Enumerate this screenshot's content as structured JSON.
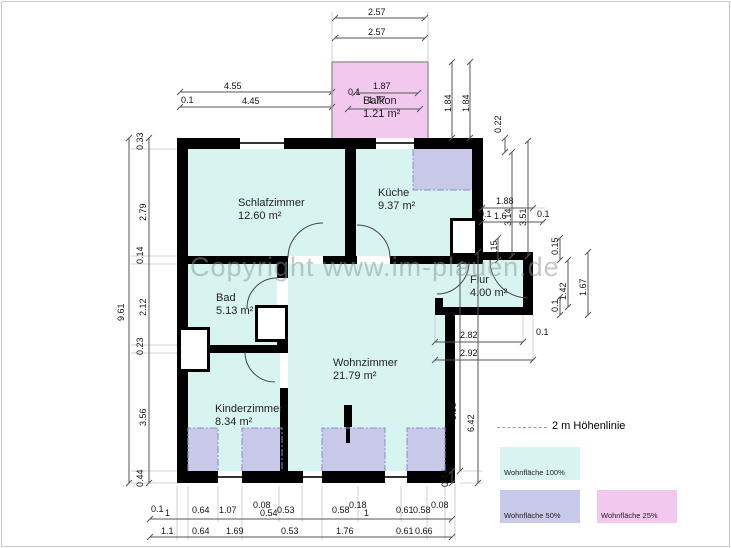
{
  "watermark": "Copyright www.im-plauen.de",
  "colors": {
    "room": "#d8f4f1",
    "area50": "#c8c8e9",
    "area25": "#f3c8ef",
    "wall": "#000000",
    "dim_line": "#555555",
    "ext_line": "#c4c4c4",
    "hoehenlinie": "#8c8cc8"
  },
  "rooms": [
    {
      "name": "Schlafzimmer",
      "area": "12.60 m²",
      "x": 238,
      "y": 197
    },
    {
      "name": "Küche",
      "area": "9.37 m²",
      "x": 378,
      "y": 187
    },
    {
      "name": "Bad",
      "area": "5.13 m²",
      "x": 216,
      "y": 292
    },
    {
      "name": "Flur",
      "area": "4.00 m²",
      "x": 470,
      "y": 274
    },
    {
      "name": "Wohnzimmer",
      "area": "21.79 m²",
      "x": 333,
      "y": 357
    },
    {
      "name": "Kinderzimmer",
      "area": "8.34 m²",
      "x": 215,
      "y": 403
    },
    {
      "name": "Balkon",
      "area": "1.21 m²",
      "x": 363,
      "y": 95
    }
  ],
  "legend": {
    "line_label": "2 m Höhenlinie",
    "items": [
      {
        "label": "Wohnfläche 100%",
        "color": "#d8f4f1",
        "x": 500,
        "y": 447
      },
      {
        "label": "Wohnfläche 50%",
        "color": "#c8c8e9",
        "x": 500,
        "y": 490
      },
      {
        "label": "Wohnfläche 25%",
        "color": "#f3c8ef",
        "x": 597,
        "y": 490
      }
    ]
  },
  "fills": [
    {
      "n": "room-fill-schlafzimmer",
      "x": 188,
      "y": 149,
      "w": 157,
      "h": 107,
      "c": "room"
    },
    {
      "n": "room-fill-kueche",
      "x": 356,
      "y": 149,
      "w": 116,
      "h": 107,
      "c": "room"
    },
    {
      "n": "area50-kueche",
      "x": 413,
      "y": 149,
      "w": 59,
      "h": 41,
      "c": "area50"
    },
    {
      "n": "room-fill-bad",
      "x": 188,
      "y": 264,
      "w": 89,
      "h": 81,
      "c": "room"
    },
    {
      "n": "room-fill-kinderzimmer",
      "x": 188,
      "y": 353,
      "w": 92,
      "h": 118,
      "c": "room"
    },
    {
      "n": "room-fill-wohnzimmer",
      "x": 288,
      "y": 264,
      "w": 157,
      "h": 207,
      "c": "room"
    },
    {
      "n": "room-fill-flur",
      "x": 443,
      "y": 260,
      "w": 80,
      "h": 47,
      "c": "room"
    },
    {
      "n": "room-fill-flur-passage",
      "x": 435,
      "y": 264,
      "w": 8,
      "h": 34,
      "c": "room"
    },
    {
      "n": "area50-strip-1",
      "x": 188,
      "y": 428,
      "w": 30,
      "h": 43,
      "c": "area50"
    },
    {
      "n": "area50-strip-2",
      "x": 242,
      "y": 428,
      "w": 40,
      "h": 43,
      "c": "area50"
    },
    {
      "n": "area50-strip-3",
      "x": 322,
      "y": 428,
      "w": 63,
      "h": 43,
      "c": "area50"
    },
    {
      "n": "area50-strip-4",
      "x": 407,
      "y": 428,
      "w": 38,
      "h": 43,
      "c": "area50"
    },
    {
      "n": "area25-balkon",
      "x": 332,
      "y": 62,
      "w": 96,
      "h": 76,
      "c": "area25"
    }
  ],
  "walls": [
    {
      "x": 177,
      "y": 138,
      "w": 11,
      "h": 345
    },
    {
      "x": 177,
      "y": 138,
      "w": 63,
      "h": 11
    },
    {
      "x": 284,
      "y": 138,
      "w": 92,
      "h": 11
    },
    {
      "x": 414,
      "y": 138,
      "w": 69,
      "h": 11
    },
    {
      "x": 345,
      "y": 149,
      "w": 11,
      "h": 107
    },
    {
      "x": 472,
      "y": 149,
      "w": 11,
      "h": 103
    },
    {
      "x": 472,
      "y": 252,
      "w": 61,
      "h": 8
    },
    {
      "x": 523,
      "y": 252,
      "w": 10,
      "h": 63
    },
    {
      "x": 435,
      "y": 307,
      "w": 98,
      "h": 8
    },
    {
      "x": 435,
      "y": 256,
      "w": 48,
      "h": 8
    },
    {
      "x": 435,
      "y": 298,
      "w": 8,
      "h": 9
    },
    {
      "x": 177,
      "y": 256,
      "w": 111,
      "h": 8
    },
    {
      "x": 323,
      "y": 256,
      "w": 34,
      "h": 8
    },
    {
      "x": 390,
      "y": 256,
      "w": 45,
      "h": 8
    },
    {
      "x": 277,
      "y": 264,
      "w": 11,
      "h": 14
    },
    {
      "x": 277,
      "y": 342,
      "w": 11,
      "h": 3
    },
    {
      "x": 177,
      "y": 345,
      "w": 111,
      "h": 8
    },
    {
      "x": 280,
      "y": 388,
      "w": 8,
      "h": 83
    },
    {
      "x": 445,
      "y": 307,
      "w": 10,
      "h": 176
    },
    {
      "x": 177,
      "y": 471,
      "w": 41,
      "h": 12
    },
    {
      "x": 242,
      "y": 471,
      "w": 61,
      "h": 12
    },
    {
      "x": 322,
      "y": 471,
      "w": 63,
      "h": 12
    },
    {
      "x": 407,
      "y": 471,
      "w": 48,
      "h": 12
    },
    {
      "x": 344,
      "y": 405,
      "w": 8,
      "h": 22
    },
    {
      "x": 346,
      "y": 427,
      "w": 4,
      "h": 16
    }
  ],
  "white_boxes": [
    {
      "n": "wall-niche",
      "x": 450,
      "y": 218,
      "w": 28,
      "h": 38
    },
    {
      "n": "shaft",
      "x": 255,
      "y": 305,
      "w": 33,
      "h": 37
    },
    {
      "n": "shaft",
      "x": 178,
      "y": 327,
      "w": 32,
      "h": 45
    }
  ],
  "svg": {
    "windows": [
      [
        240,
        143,
        284,
        143
      ],
      [
        376,
        143,
        414,
        143
      ],
      [
        218,
        477,
        242,
        477
      ],
      [
        303,
        477,
        322,
        477
      ],
      [
        385,
        477,
        407,
        477
      ]
    ],
    "rails": [
      [
        332,
        62,
        428,
        62
      ],
      [
        332,
        62,
        332,
        138
      ],
      [
        428,
        62,
        428,
        138
      ]
    ],
    "door_arcs": [
      "M288,258 A35,35 0 0 1 323,223",
      "M390,258 A33,33 0 0 0 357,225",
      "M277,278 A30,30 0 0 0 247,308",
      "M275,382 A30,30 0 0 1 245,352",
      "M490,260 A38,38 0 0 0 528,298",
      "M437,294 A32,32 0 0 0 469,262"
    ],
    "hoehenlinien": [
      "M413,149 L413,190 L472,190",
      "M188,471 L188,428 L218,428 L218,471",
      "M242,471 L242,428 L282,428 L282,471",
      "M322,471 L322,428 L385,428 L385,471",
      "M407,471 L407,428 L445,428 L445,471"
    ],
    "dim_lines": [
      [
        335,
        18,
        425,
        18
      ],
      [
        335,
        38,
        425,
        38
      ],
      [
        180,
        92,
        332,
        92
      ],
      [
        180,
        107,
        332,
        107
      ],
      [
        355,
        93,
        418,
        93
      ],
      [
        348,
        109,
        420,
        109
      ],
      [
        452,
        62,
        452,
        138
      ],
      [
        470,
        62,
        470,
        138
      ],
      [
        505,
        138,
        505,
        152
      ],
      [
        149,
        138,
        149,
        483
      ],
      [
        129,
        138,
        129,
        483
      ],
      [
        482,
        208,
        533,
        208
      ],
      [
        482,
        222,
        543,
        222
      ],
      [
        512,
        152,
        512,
        256
      ],
      [
        528,
        141,
        528,
        256
      ],
      [
        498,
        238,
        498,
        260
      ],
      [
        560,
        238,
        560,
        260
      ],
      [
        568,
        260,
        568,
        307
      ],
      [
        588,
        252,
        588,
        315
      ],
      [
        560,
        297,
        560,
        315
      ],
      [
        435,
        342,
        523,
        342
      ],
      [
        435,
        360,
        533,
        360
      ],
      [
        460,
        264,
        460,
        471
      ],
      [
        478,
        252,
        478,
        483
      ],
      [
        452,
        471,
        452,
        483
      ],
      [
        150,
        519,
        452,
        519
      ],
      [
        150,
        537,
        452,
        537
      ]
    ],
    "ext_lines": [
      [
        332,
        12,
        332,
        62
      ],
      [
        428,
        12,
        428,
        62
      ],
      [
        131,
        149,
        177,
        149
      ],
      [
        131,
        256,
        177,
        256
      ],
      [
        131,
        264,
        177,
        264
      ],
      [
        131,
        345,
        177,
        345
      ],
      [
        131,
        353,
        177,
        353
      ],
      [
        131,
        471,
        177,
        471
      ],
      [
        131,
        483,
        177,
        483
      ],
      [
        177,
        486,
        177,
        540
      ],
      [
        188,
        486,
        188,
        540
      ],
      [
        218,
        486,
        218,
        522
      ],
      [
        242,
        486,
        242,
        540
      ],
      [
        279,
        486,
        279,
        522
      ],
      [
        302,
        486,
        302,
        522
      ],
      [
        322,
        486,
        322,
        540
      ],
      [
        358,
        486,
        358,
        522
      ],
      [
        401,
        486,
        401,
        522
      ],
      [
        427,
        486,
        427,
        540
      ],
      [
        445,
        486,
        445,
        540
      ],
      [
        455,
        486,
        455,
        540
      ],
      [
        483,
        208,
        545,
        208
      ],
      [
        533,
        222,
        545,
        222
      ],
      [
        435,
        315,
        435,
        342
      ],
      [
        523,
        315,
        523,
        342
      ],
      [
        533,
        315,
        533,
        360
      ],
      [
        455,
        483,
        455,
        495
      ],
      [
        460,
        471,
        483,
        471
      ],
      [
        460,
        483,
        483,
        483
      ]
    ]
  },
  "dim_labels": [
    {
      "t": "2.57",
      "x": 368,
      "y": 8
    },
    {
      "t": "2.57",
      "x": 368,
      "y": 28
    },
    {
      "t": "4.55",
      "x": 224,
      "y": 82
    },
    {
      "t": "0.1",
      "x": 181,
      "y": 96
    },
    {
      "t": "4.45",
      "x": 242,
      "y": 97
    },
    {
      "t": "1.87",
      "x": 373,
      "y": 82
    },
    {
      "t": "0.1",
      "x": 348,
      "y": 88
    },
    {
      "t": "1.77",
      "x": 368,
      "y": 96
    },
    {
      "t": "1.84",
      "x": 444,
      "y": 112,
      "r": 1
    },
    {
      "t": "1.84",
      "x": 462,
      "y": 112,
      "r": 1
    },
    {
      "t": "0.22",
      "x": 494,
      "y": 133,
      "r": 1
    },
    {
      "t": "0.33",
      "x": 136,
      "y": 150,
      "r": 1
    },
    {
      "t": "2.79",
      "x": 139,
      "y": 221,
      "r": 1
    },
    {
      "t": "0.14",
      "x": 136,
      "y": 264,
      "r": 1
    },
    {
      "t": "2.12",
      "x": 139,
      "y": 316,
      "r": 1
    },
    {
      "t": "0.23",
      "x": 136,
      "y": 355,
      "r": 1
    },
    {
      "t": "3.56",
      "x": 139,
      "y": 426,
      "r": 1
    },
    {
      "t": "0.44",
      "x": 136,
      "y": 487,
      "r": 1
    },
    {
      "t": "9.61",
      "x": 117,
      "y": 321,
      "r": 1
    },
    {
      "t": "1.88",
      "x": 496,
      "y": 197
    },
    {
      "t": "0.1",
      "x": 479,
      "y": 210
    },
    {
      "t": "1.6",
      "x": 494,
      "y": 212
    },
    {
      "t": "3.14",
      "x": 504,
      "y": 226,
      "r": 1
    },
    {
      "t": "3.51",
      "x": 519,
      "y": 226,
      "r": 1
    },
    {
      "t": "0.1",
      "x": 537,
      "y": 210
    },
    {
      "t": "0.15",
      "x": 490,
      "y": 258,
      "r": 1
    },
    {
      "t": "0.15",
      "x": 551,
      "y": 255,
      "r": 1
    },
    {
      "t": "1.42",
      "x": 559,
      "y": 300,
      "r": 1
    },
    {
      "t": "1.67",
      "x": 579,
      "y": 296,
      "r": 1
    },
    {
      "t": "0.1",
      "x": 551,
      "y": 312,
      "r": 1
    },
    {
      "t": "0.1",
      "x": 536,
      "y": 328
    },
    {
      "t": "2.82",
      "x": 460,
      "y": 331
    },
    {
      "t": "2.92",
      "x": 460,
      "y": 349
    },
    {
      "t": "5.98",
      "x": 449,
      "y": 420,
      "r": 1
    },
    {
      "t": "6.42",
      "x": 467,
      "y": 432,
      "r": 1
    },
    {
      "t": "0.44",
      "x": 441,
      "y": 487,
      "r": 1
    },
    {
      "t": "0.1",
      "x": 151,
      "y": 505
    },
    {
      "t": "1",
      "x": 165,
      "y": 509
    },
    {
      "t": "0.64",
      "x": 192,
      "y": 506
    },
    {
      "t": "1.07",
      "x": 219,
      "y": 506
    },
    {
      "t": "0.08",
      "x": 253,
      "y": 501
    },
    {
      "t": "0.54",
      "x": 260,
      "y": 509
    },
    {
      "t": "0.53",
      "x": 277,
      "y": 506
    },
    {
      "t": "0.58",
      "x": 332,
      "y": 506
    },
    {
      "t": "0.18",
      "x": 349,
      "y": 501
    },
    {
      "t": "1",
      "x": 364,
      "y": 509
    },
    {
      "t": "0.61",
      "x": 396,
      "y": 506
    },
    {
      "t": "0.58",
      "x": 413,
      "y": 506
    },
    {
      "t": "0.08",
      "x": 431,
      "y": 501
    },
    {
      "t": "1.1",
      "x": 161,
      "y": 527
    },
    {
      "t": "0.64",
      "x": 192,
      "y": 527
    },
    {
      "t": "1.69",
      "x": 226,
      "y": 527
    },
    {
      "t": "0.53",
      "x": 281,
      "y": 527
    },
    {
      "t": "1.76",
      "x": 336,
      "y": 527
    },
    {
      "t": "0.61",
      "x": 396,
      "y": 527
    },
    {
      "t": "0.66",
      "x": 415,
      "y": 527
    }
  ]
}
